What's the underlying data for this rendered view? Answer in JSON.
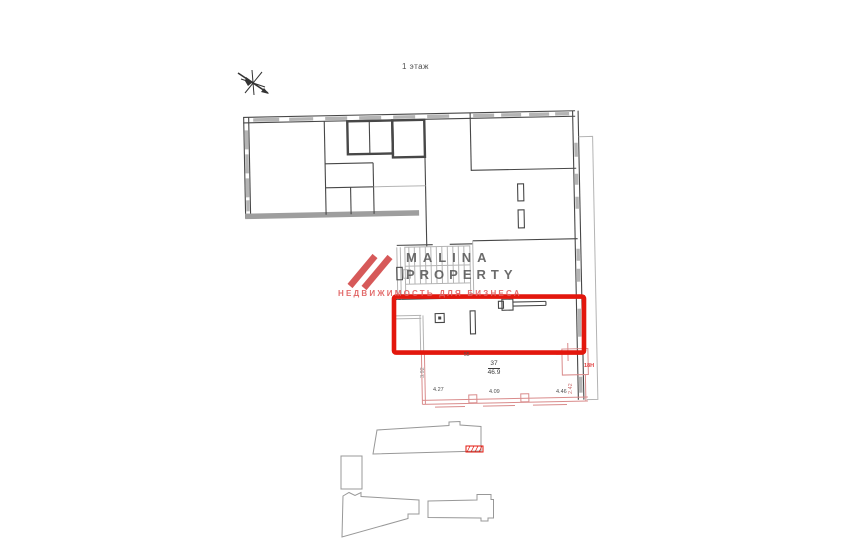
{
  "page": {
    "floor_label": "1 этаж"
  },
  "watermark": {
    "brand_line1": "MALINA",
    "brand_line2": "PROPERTY",
    "tagline": "НЕДВИЖИМОСТЬ ДЛЯ БИЗНЕСА"
  },
  "unit": {
    "number": "37",
    "area": "46.9",
    "zone_label": "18Н",
    "inline_note": "55"
  },
  "dimensions": {
    "bottom": [
      "4.27",
      "4.09",
      "4.46"
    ],
    "left_height": "3.92",
    "right_height": "2.42"
  },
  "colors": {
    "wall_dark": "#474747",
    "wall_light": "#b4b4b4",
    "wall_thick": "#9e9e9e",
    "highlight": "#e3170d",
    "unit_outline": "#d98b8b",
    "keyplan": "#989898",
    "dim_text": "#4f4f4f",
    "logo_red": "#d24b4b",
    "wm_gray": "#585858",
    "wm_red": "#e06060"
  }
}
